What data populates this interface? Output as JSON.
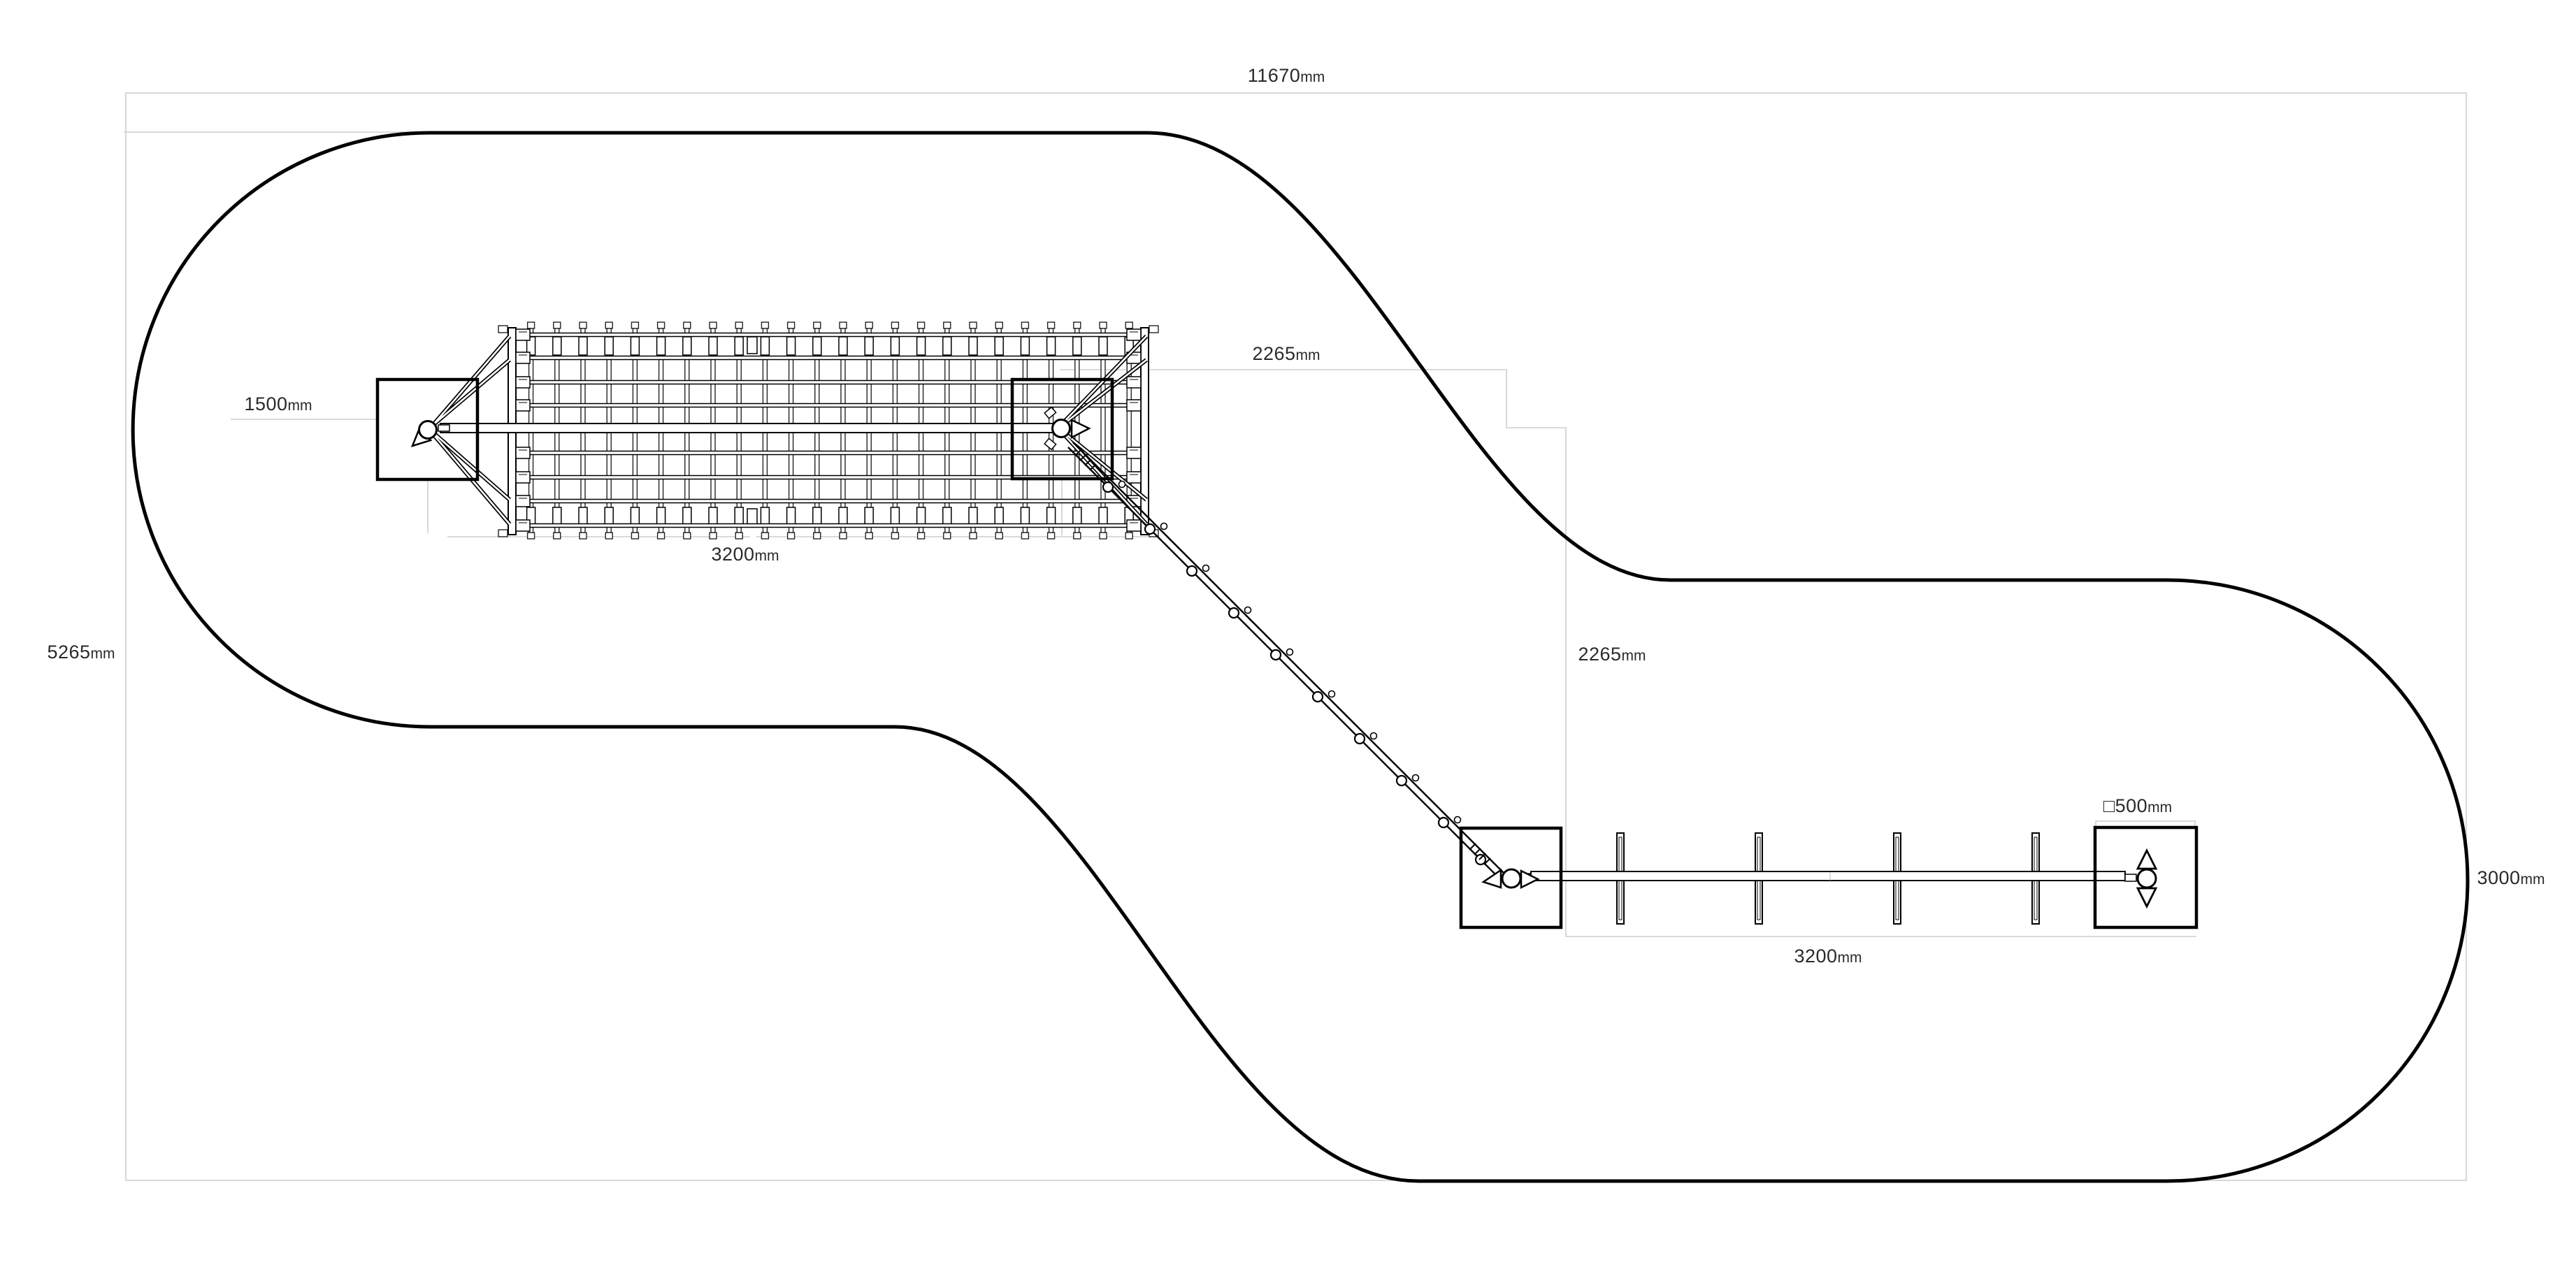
{
  "drawing": {
    "kind": "equipment plan view technical drawing",
    "colors": {
      "outline": "#000000",
      "guide_line": "#cbd0cc",
      "label_text": "#2a2a2a",
      "background": "#ffffff"
    },
    "dimensions": {
      "total_width": {
        "value": "11670",
        "unit": "mm"
      },
      "overall_height": {
        "value": "5265",
        "unit": "mm"
      },
      "left_offset": {
        "value": "1500",
        "unit": "mm"
      },
      "net_length": {
        "value": "3200",
        "unit": "mm"
      },
      "upper_clearance": {
        "value": "2265",
        "unit": "mm"
      },
      "middle_clearance": {
        "value": "2265",
        "unit": "mm"
      },
      "post_section": {
        "value": "□500",
        "unit": "mm"
      },
      "lower_zone_height": {
        "value": "3000",
        "unit": "mm"
      },
      "beam_length": {
        "value": "3200",
        "unit": "mm"
      }
    },
    "icons": {
      "swivel_vertical": "swivel-joint-up-down-arrows",
      "swivel_horizontal": "swivel-joint-left-right-arrows",
      "pivot": "pivot-circle"
    }
  }
}
